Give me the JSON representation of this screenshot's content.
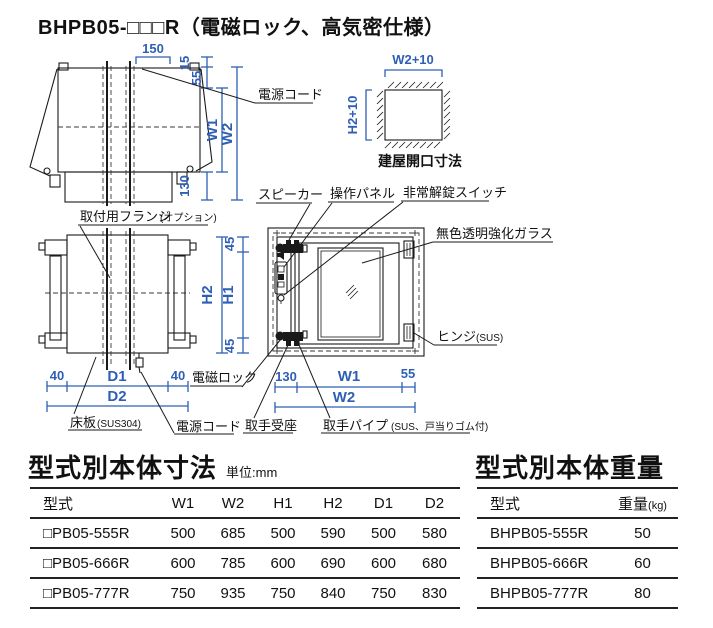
{
  "title": "BHPB05-□□□R（電磁ロック、高気密仕様）",
  "colors": {
    "dimension_blue": "#2e5fb5",
    "line_black": "#1a1a1a"
  },
  "diagram": {
    "top_view": {
      "dims": {
        "d150": "150",
        "d15": "15",
        "d55": "55",
        "w1": "W1",
        "w2": "W2",
        "d130": "130"
      },
      "labels": {
        "power_cord": "電源コード",
        "mounting_flange": "取付用フランジ",
        "mounting_flange_note": "(オプション)"
      }
    },
    "opening": {
      "w": "W2+10",
      "h": "H2+10",
      "caption": "建屋開口寸法"
    },
    "plan_view": {
      "dims": {
        "d40l": "40",
        "d1": "D1",
        "d40r": "40",
        "d2": "D2"
      },
      "labels": {
        "floor_plate": "床板",
        "floor_plate_note": "(SUS304)",
        "power_cord": "電源コード"
      }
    },
    "front_view": {
      "dims": {
        "d45t": "45",
        "h2": "H2",
        "h1": "H1",
        "d45b": "45",
        "d130": "130",
        "w1": "W1",
        "d55": "55",
        "w2": "W2"
      },
      "labels": {
        "speaker": "スピーカー",
        "panel": "操作パネル",
        "emergency": "非常解錠スイッチ",
        "glass": "無色透明強化ガラス",
        "hinge": "ヒンジ",
        "hinge_note": "(SUS)",
        "maglock": "電磁ロック",
        "handle_seat": "取手受座",
        "handle_pipe": "取手パイプ",
        "handle_pipe_note": "(SUS、戸当りゴム付)"
      }
    }
  },
  "size_table": {
    "title": "型式別本体寸法",
    "unit": "単位:mm",
    "headers": [
      "型式",
      "W1",
      "W2",
      "H1",
      "H2",
      "D1",
      "D2"
    ],
    "rows": [
      [
        "□PB05-555R",
        "500",
        "685",
        "500",
        "590",
        "500",
        "580"
      ],
      [
        "□PB05-666R",
        "600",
        "785",
        "600",
        "690",
        "600",
        "680"
      ],
      [
        "□PB05-777R",
        "750",
        "935",
        "750",
        "840",
        "750",
        "830"
      ]
    ]
  },
  "weight_table": {
    "title": "型式別本体重量",
    "headers": {
      "model": "型式",
      "weight": "重量",
      "weight_unit": "(kg)"
    },
    "rows": [
      [
        "BHPB05-555R",
        "50"
      ],
      [
        "BHPB05-666R",
        "60"
      ],
      [
        "BHPB05-777R",
        "80"
      ]
    ]
  }
}
